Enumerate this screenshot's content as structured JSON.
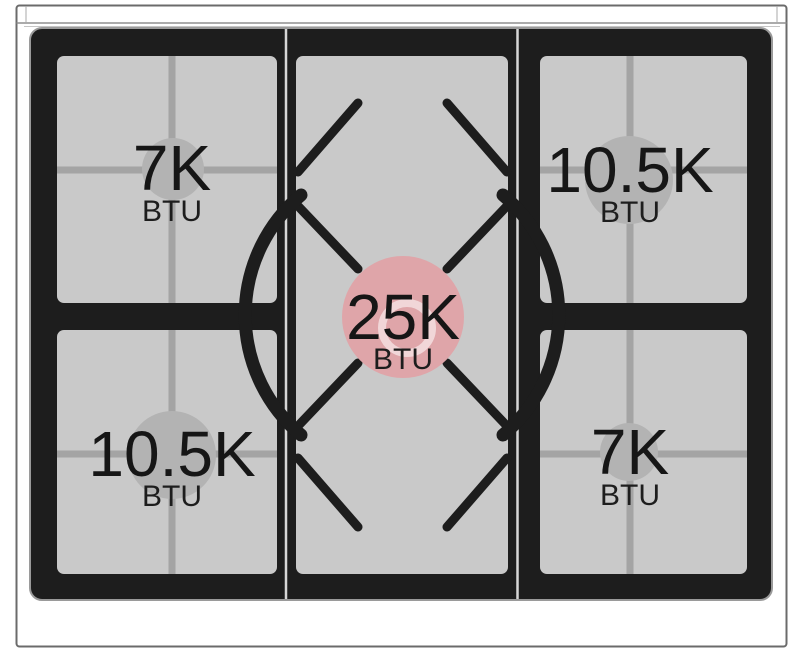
{
  "burners": [
    {
      "position": "top-left",
      "power": "7K",
      "unit": "BTU",
      "size": "small"
    },
    {
      "position": "top-right",
      "power": "10.5K",
      "unit": "BTU",
      "size": "medium"
    },
    {
      "position": "center",
      "power": "25K",
      "unit": "BTU",
      "size": "large"
    },
    {
      "position": "bottom-left",
      "power": "10.5K",
      "unit": "BTU",
      "size": "medium"
    },
    {
      "position": "bottom-right",
      "power": "7K",
      "unit": "BTU",
      "size": "small"
    }
  ],
  "colors": {
    "center_burner_highlight": "#dfa5a9",
    "standard_burner": "#b3b3b3",
    "grate_surface": "#c9c9c9",
    "grate_frame": "#1d1d1d",
    "body_fill": "#ffffff"
  }
}
